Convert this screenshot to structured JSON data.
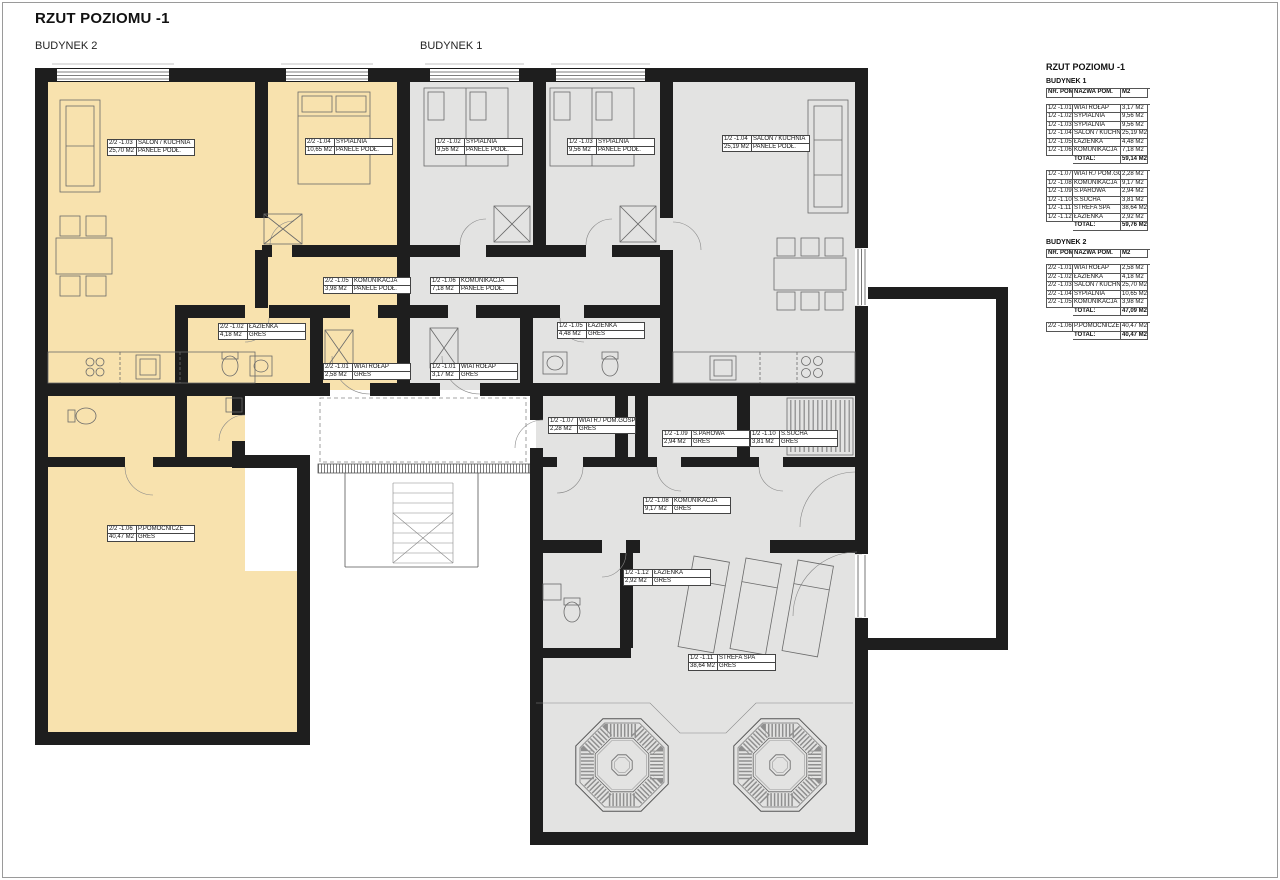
{
  "page": {
    "title": "RZUT POZIOMU -1",
    "building2_label": "BUDYNEK 2",
    "building1_label": "BUDYNEK 1"
  },
  "colors": {
    "building1_fill": "#e3e3e2",
    "building2_fill": "#f8e2ae",
    "wall": "#1e1e1e"
  },
  "plan_rooms": [
    {
      "number": "2/2 -1.03",
      "name": "SALON / KUCHNIA",
      "area": "25,70 M2",
      "floor": "PANELE PODŁ."
    },
    {
      "number": "2/2 -1.04",
      "name": "SYPIALNIA",
      "area": "10,65 M2",
      "floor": "PANELE PODŁ."
    },
    {
      "number": "2/2 -1.05",
      "name": "KOMUNIKACJA",
      "area": "3,98 M2",
      "floor": "PANELE PODŁ."
    },
    {
      "number": "2/2 -1.02",
      "name": "ŁAZIENKA",
      "area": "4,18 M2",
      "floor": "GRES"
    },
    {
      "number": "2/2 -1.01",
      "name": "WIATROŁAP",
      "area": "2,58 M2",
      "floor": "GRES"
    },
    {
      "number": "2/2 -1.06",
      "name": "P.POMOCNICZE",
      "area": "40,47 M2",
      "floor": "GRES"
    },
    {
      "number": "1/2 -1.02",
      "name": "SYPIALNIA",
      "area": "9,56 M2",
      "floor": "PANELE PODŁ."
    },
    {
      "number": "1/2 -1.03",
      "name": "SYPIALNIA",
      "area": "9,56 M2",
      "floor": "PANELE PODŁ."
    },
    {
      "number": "1/2 -1.04",
      "name": "SALON / KUCHNIA",
      "area": "25,19 M2",
      "floor": "PANELE PODŁ."
    },
    {
      "number": "1/2 -1.06",
      "name": "KOMUNIKACJA",
      "area": "7,18 M2",
      "floor": "PANELE PODŁ."
    },
    {
      "number": "1/2 -1.05",
      "name": "ŁAZIENKA",
      "area": "4,48 M2",
      "floor": "GRES"
    },
    {
      "number": "1/2 -1.01",
      "name": "WIATROŁAP",
      "area": "3,17 M2",
      "floor": "GRES"
    },
    {
      "number": "1/2 -1.07",
      "name": "WIATR./ POM.GOSP.",
      "area": "2,28 M2",
      "floor": "GRES"
    },
    {
      "number": "1/2 -1.09",
      "name": "S.PAROWA",
      "area": "2,94 M2",
      "floor": "GRES"
    },
    {
      "number": "1/2 -1.10",
      "name": "S.SUCHA",
      "area": "3,81 M2",
      "floor": "GRES"
    },
    {
      "number": "1/2 -1.08",
      "name": "KOMUNIKACJA",
      "area": "9,17 M2",
      "floor": "GRES"
    },
    {
      "number": "1/2 -1.12",
      "name": "ŁAZIENKA",
      "area": "2,92 M2",
      "floor": "GRES"
    },
    {
      "number": "1/2 -1.11",
      "name": "STREFA SPA",
      "area": "38,64 M2",
      "floor": "GRES"
    }
  ],
  "legend": {
    "title": "RZUT POZIOMU -1",
    "b1_title": "BUDYNEK 1",
    "b2_title": "BUDYNEK 2",
    "columns": [
      "NR. POM.",
      "NAZWA POM.",
      "M2"
    ],
    "total_label": "TOTAL:",
    "b1_block1": {
      "rows": [
        [
          "1/2 -1.01",
          "WIATROŁAP",
          "3,17 M2"
        ],
        [
          "1/2 -1.02",
          "SYPIALNIA",
          "9,56 M2"
        ],
        [
          "1/2 -1.03",
          "SYPIALNIA",
          "9,56 M2"
        ],
        [
          "1/2 -1.04",
          "SALON / KUCHNIA",
          "25,19 M2"
        ],
        [
          "1/2 -1.05",
          "ŁAZIENKA",
          "4,48 M2"
        ],
        [
          "1/2 -1.06",
          "KOMUNIKACJA",
          "7,18 M2"
        ]
      ],
      "total": "59,14 M2"
    },
    "b1_block2": {
      "rows": [
        [
          "1/2 -1.07",
          "WIATR./ POM.GOSP.",
          "2,28 M2"
        ],
        [
          "1/2 -1.08",
          "KOMUNIKACJA",
          "9,17 M2"
        ],
        [
          "1/2 -1.09",
          "S.PAROWA",
          "2,94 M2"
        ],
        [
          "1/2 -1.10",
          "S.SUCHA",
          "3,81 M2"
        ],
        [
          "1/2 -1.11",
          "STREFA SPA",
          "38,64 M2"
        ],
        [
          "1/2 -1.12",
          "ŁAZIENKA",
          "2,92 M2"
        ]
      ],
      "total": "59,76 M2"
    },
    "b2_block1": {
      "rows": [
        [
          "2/2 -1.01",
          "WIATROŁAP",
          "2,58 M2"
        ],
        [
          "2/2 -1.02",
          "ŁAZIENKA",
          "4,18 M2"
        ],
        [
          "2/2 -1.03",
          "SALON / KUCHNIA",
          "25,70 M2"
        ],
        [
          "2/2 -1.04",
          "SYPIALNIA",
          "10,65 M2"
        ],
        [
          "2/2 -1.05",
          "KOMUNIKACJA",
          "3,98 M2"
        ]
      ],
      "total": "47,09 M2"
    },
    "b2_block2": {
      "rows": [
        [
          "2/2 -1.06",
          "P.POMOCNICZE",
          "40,47 M2"
        ]
      ],
      "total": "40,47 M2"
    }
  }
}
